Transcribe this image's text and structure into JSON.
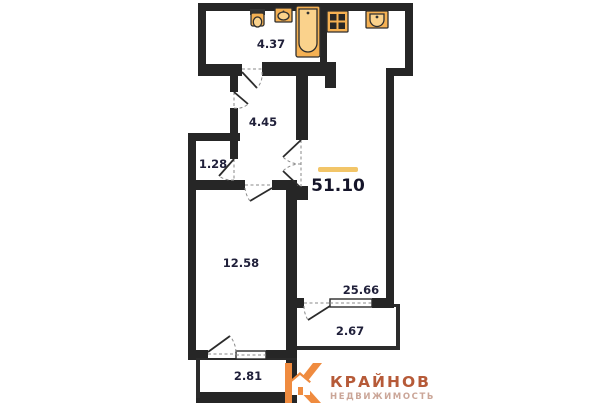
{
  "floorplan": {
    "total_area": "51.10",
    "rooms": {
      "bathroom": {
        "area": "4.37"
      },
      "hallway": {
        "area": "4.45"
      },
      "closet": {
        "area": "1.28"
      },
      "bedroom": {
        "area": "12.58"
      },
      "living_room": {
        "area": "25.66"
      },
      "balcony_right": {
        "area": "2.67"
      },
      "balcony_left": {
        "area": "2.81"
      }
    },
    "fixtures": [
      "toilet-icon",
      "bath-sink-icon",
      "bathtub-icon",
      "stove-icon",
      "kitchen-sink-icon"
    ],
    "colors": {
      "wall": "#262626",
      "fixture": "#f5b153",
      "fixture_light": "#fad28c",
      "area_accent": "#f2c568",
      "label_text": "#20203a"
    }
  },
  "logo": {
    "brand": "КРАЙНОВ",
    "subtitle": "НЕДВИЖИМОСТЬ",
    "colors": {
      "mark": "#ef8b3f",
      "brand": "#b65a38",
      "subtitle": "#cba698"
    }
  }
}
